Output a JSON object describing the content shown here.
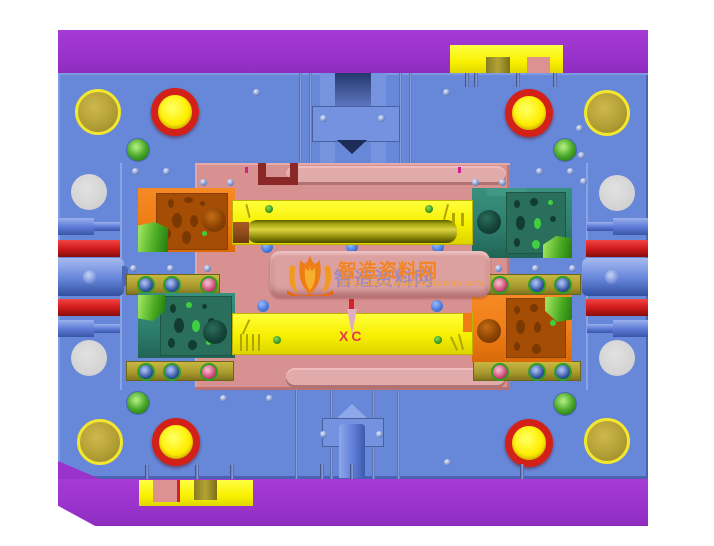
{
  "view": {
    "type": "cad-mold-assembly-top-view",
    "background": "#ffffff",
    "width": 714,
    "height": 546
  },
  "annotations": {
    "coordinate_label": "XC"
  },
  "watermark": {
    "title": "智造资料网",
    "subtitle": "INTELLIGENT MANUFACTURING DATA",
    "logo": "flame-book-icon",
    "color": "#f08228"
  },
  "palette": {
    "clamp_plate_purple": "#9933cc",
    "base_plate_blue": "#6787d8",
    "cavity_plate_pink": "#d89191",
    "insert_yellow": "#f7ef00",
    "slider_orange": "#ef7d15",
    "slider_teal": "#2e7f6e",
    "gib_strip_olive": "#b3a335",
    "guide_ring_red": "#d32018",
    "plug_green": "#49a82a",
    "support_bar_red": "#d01c1c",
    "waterline_dot_blue": "#4a7de0",
    "label_red": "#e03a50",
    "core_cylinder_olive": "#a8a812"
  },
  "parts": [
    {
      "name": "top-clamp-plate",
      "color": "#9933cc"
    },
    {
      "name": "bottom-clamp-plate",
      "color": "#9933cc"
    },
    {
      "name": "mold-base-plate",
      "color": "#6787d8"
    },
    {
      "name": "cavity-plate",
      "color": "#d89191"
    },
    {
      "name": "upper-core-insert",
      "color": "#f7ef00"
    },
    {
      "name": "lower-core-insert",
      "color": "#f7ef00"
    },
    {
      "name": "slider-block-orange-top-left",
      "color": "#ef7d15"
    },
    {
      "name": "slider-block-teal-bottom-left",
      "color": "#2e7f6e"
    },
    {
      "name": "slider-block-teal-top-right",
      "color": "#2e7f6e"
    },
    {
      "name": "slider-block-orange-bottom-right",
      "color": "#ef7d15"
    },
    {
      "name": "gib-strips",
      "color": "#b3a335"
    },
    {
      "name": "guide-pins",
      "color": "#d32018"
    },
    {
      "name": "guide-bushings",
      "color": "#b3a035"
    },
    {
      "name": "return-pins",
      "color": "#d2d2d2"
    },
    {
      "name": "green-plugs",
      "color": "#49a82a"
    },
    {
      "name": "side-support-rods",
      "color": "#5f7ed8"
    },
    {
      "name": "red-spacer-bars",
      "color": "#d01c1c"
    }
  ]
}
